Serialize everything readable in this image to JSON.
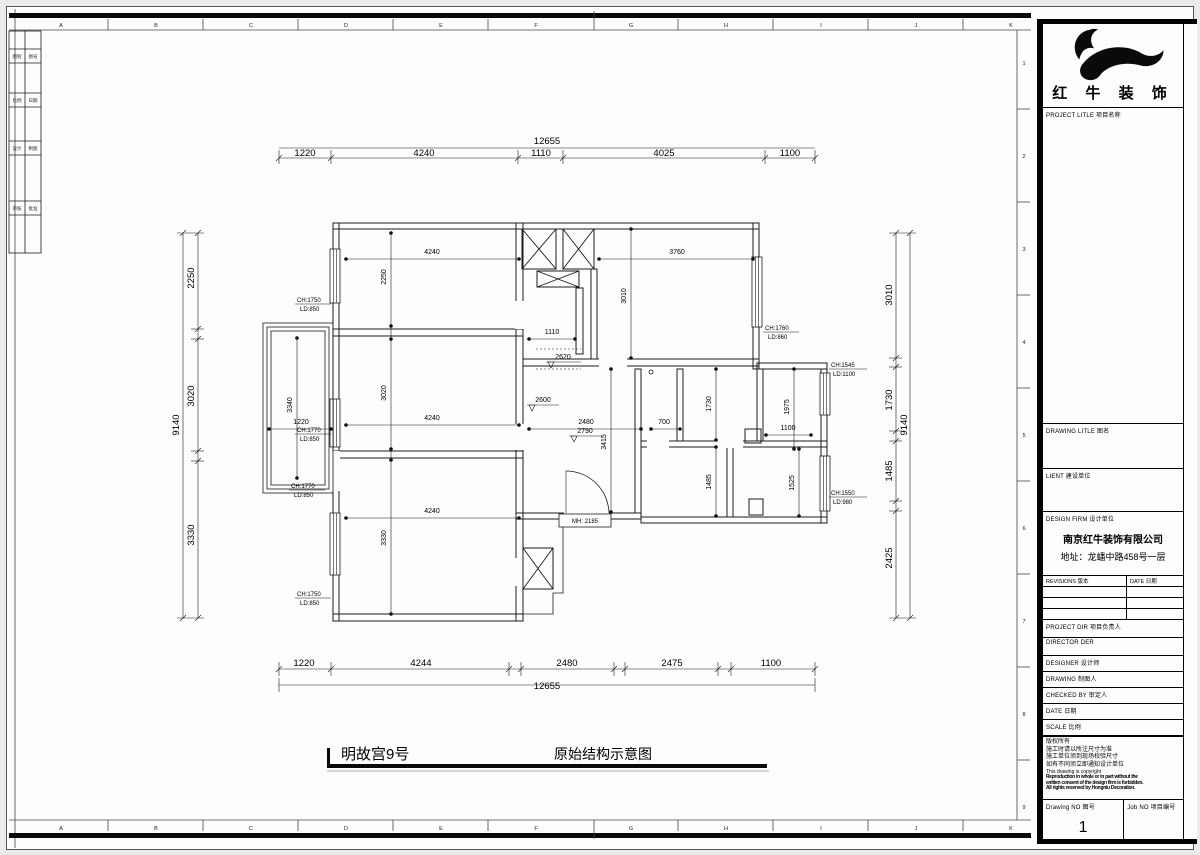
{
  "sheet": {
    "cols": [
      "A",
      "B",
      "C",
      "D",
      "E",
      "F",
      "G",
      "H",
      "I",
      "J",
      "K"
    ],
    "rows": [
      "1",
      "2",
      "3",
      "4",
      "5",
      "6",
      "7",
      "8",
      "9"
    ],
    "stamp": [
      [
        "图别",
        "图号"
      ],
      [
        "比例",
        "日期"
      ],
      [
        "设计",
        "制图"
      ],
      [
        "审核",
        "批准"
      ]
    ]
  },
  "footer": {
    "project": "明故宫9号",
    "drawing": "原始结构示意图"
  },
  "dims": {
    "top": {
      "overall": "12655",
      "segs": [
        "1220",
        "4240",
        "1110",
        "4025",
        "1100"
      ]
    },
    "bottom": {
      "overall": "12655",
      "segs": [
        "1220",
        "4244",
        "2480",
        "2475",
        "1100"
      ]
    },
    "left": {
      "overall": "9140",
      "segs": [
        "2250",
        "3020",
        "3330"
      ]
    },
    "right": {
      "overall": "9140",
      "segs": [
        "3010",
        "1730",
        "1485",
        "2425"
      ]
    }
  },
  "room": {
    "tl_w": "4240",
    "tl_h": "2250",
    "ml_w": "4240",
    "ml_h": "3020",
    "bl_w": "4240",
    "bl_h": "3330",
    "bal_w": "1220",
    "bal_h": "3340",
    "corr": "1110",
    "tr_w": "3760",
    "tr_h": "3010",
    "hall_w": "2480",
    "hall_h": "3415",
    "pass": "700",
    "r_a": "1730",
    "r_b": "1975",
    "r_c": "1100",
    "r_d": "1485",
    "r_e": "1525",
    "lvl_a": "2620",
    "lvl_b": "2600",
    "lvl_c": "2790",
    "door": "MH: 2185"
  },
  "win": {
    "w1": {
      "ch": "CH:1750",
      "ld": "LD:850"
    },
    "w2": {
      "ch": "CH:1770",
      "ld": "LD:850"
    },
    "w3": {
      "ch": "CH:1770",
      "ld": "LD:850"
    },
    "w4": {
      "ch": "CH:1750",
      "ld": "LD:850"
    },
    "w5": {
      "ch": "CH:1760",
      "ld": "LD:860"
    },
    "w6": {
      "ch": "CH:1545",
      "ld": "LD:1100"
    },
    "w7": {
      "ch": "CH:1550",
      "ld": "LD:980"
    }
  },
  "tb": {
    "brand": "红 牛 装 饰",
    "project_title": "PROJECT LITLE 项目名称",
    "drawing_title": "DRAWING LITLE 图名",
    "client": "LIENT 建设单位",
    "design_firm": "DESIGN FIRM 设计单位",
    "firm_name": "南京红牛装饰有限公司",
    "firm_addr": "地址：龙蟠中路458号一层",
    "revisions": "REVISIONS 版本",
    "rev_date": "DATE 日期",
    "project_dir": "PROJECT DIR 项目负责人",
    "director": "DIRECTOR DER",
    "designer": "DESIGNER 设计师",
    "drawing_by": "DRAWING 制图人",
    "checked": "CHECKED BY 审定人",
    "date": "DATE 日期",
    "scale": "SCALE 比例",
    "notes_cn": [
      "版权所有",
      "施工时请以所注尺寸为准",
      "施工单位须到现场校验尺寸",
      "如有不同须立即通知设计单位"
    ],
    "notes_en": "This drawing is copyright",
    "notes_fine": [
      "Reproduction in whole or in part without the",
      "written consent of the design firm is forbidden.",
      "All rights reserved by Hongniu Decoration."
    ],
    "drawing_no": "Drawing NO 图号",
    "job_no": "Job NO 项目编号",
    "page": "1"
  }
}
